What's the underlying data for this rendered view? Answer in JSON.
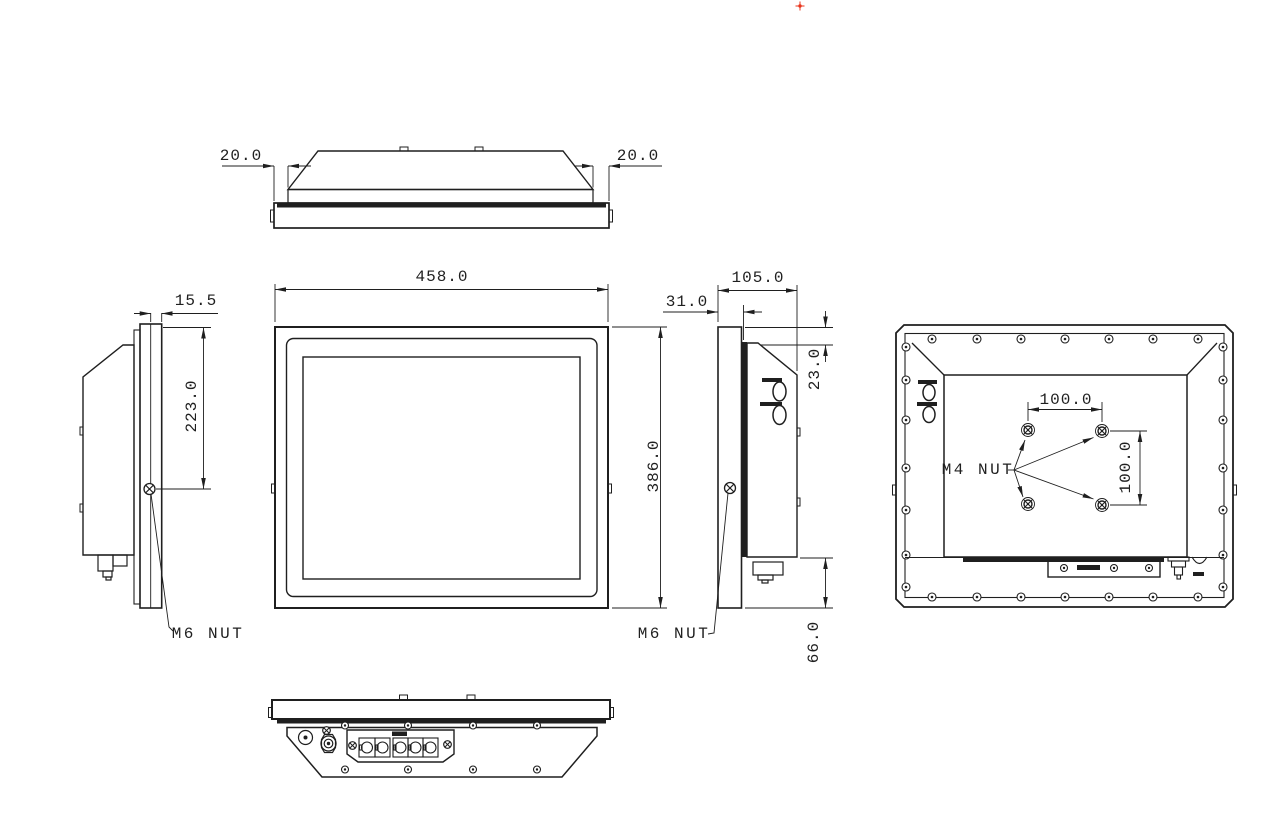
{
  "drawing": {
    "kind": "technical-drawing",
    "units": "mm",
    "views": [
      "top-view",
      "front-view",
      "left-side-view",
      "right-side-view",
      "rear-view",
      "bottom-view"
    ]
  },
  "dims": {
    "top_left_offset": "20.0",
    "top_right_offset": "20.0",
    "front_width": "458.0",
    "front_height": "386.0",
    "side_bezel_thickness": "15.5",
    "side_mount_span": "223.0",
    "side_total_depth": "105.0",
    "side_front_depth": "31.0",
    "side_top_inset": "23.0",
    "side_bottom_inset": "66.0",
    "vesa_width": "100.0",
    "vesa_height": "100.0"
  },
  "labels": {
    "left_side_nut": "M6 NUT",
    "right_side_nut": "M6 NUT",
    "vesa_nut": "M4 NUT"
  },
  "colors": {
    "line": "#1f1f1f",
    "origin_marker": "#e8341c",
    "background": "#ffffff"
  }
}
